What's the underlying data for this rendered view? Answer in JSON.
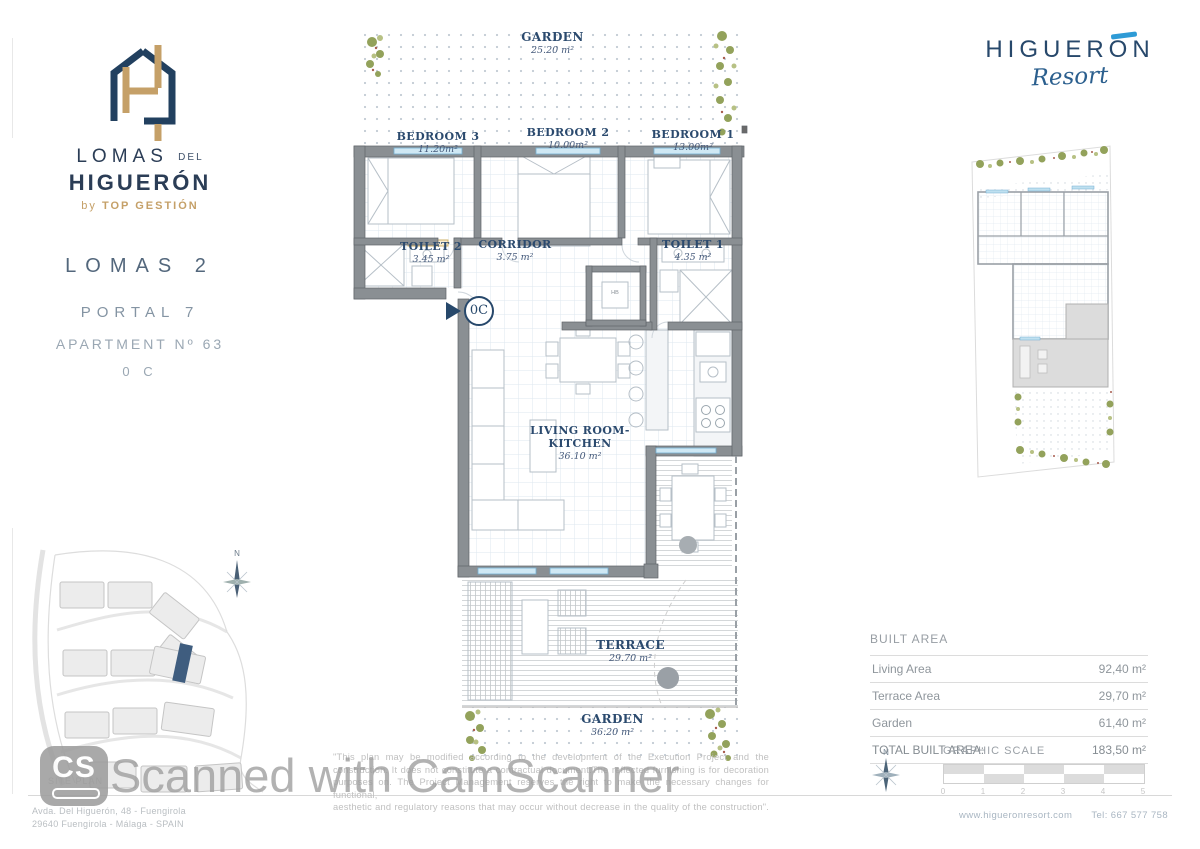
{
  "brand": {
    "line1": "LOMAS",
    "line1_small": "DEL",
    "line2": "HIGUERÓN",
    "byline_prefix": "by",
    "byline": "TOP GESTIÓN"
  },
  "unit": {
    "project": "LOMAS 2",
    "portal": "PORTAL 7",
    "apartment": "APARTMENT Nº 63",
    "code": "0 C"
  },
  "resort": {
    "name": "HIGUERON",
    "script": "Resort"
  },
  "plan": {
    "garden_top": {
      "name": "GARDEN",
      "area": "25.20 m²"
    },
    "bedroom3": {
      "name": "BEDROOM 3",
      "area": "11.20m²"
    },
    "bedroom2": {
      "name": "BEDROOM 2",
      "area": "10.00m²"
    },
    "bedroom1": {
      "name": "BEDROOM 1",
      "area": "13.00m²"
    },
    "toilet2": {
      "name": "TOILET 2",
      "area": "3.45 m²"
    },
    "corridor": {
      "name": "CORRIDOR",
      "area": "3.75 m²"
    },
    "toilet1": {
      "name": "TOILET 1",
      "area": "4.35 m²"
    },
    "living": {
      "name_line1": "LIVING ROOM-",
      "name_line2": "KITCHEN",
      "area": "36.10 m²"
    },
    "terrace": {
      "name": "TERRACE",
      "area": "29.70 m²"
    },
    "garden_bottom": {
      "name": "GARDEN",
      "area": "36.20 m²"
    },
    "entrance_code": "0C",
    "hb": "HB"
  },
  "site_plan": {
    "caption": "SITE PLAN",
    "north": "N"
  },
  "built_area": {
    "title": "BUILT AREA",
    "rows": [
      {
        "label": "Living Area",
        "value": "92,40 m²"
      },
      {
        "label": "Terrace Area",
        "value": "29,70 m²"
      },
      {
        "label": "Garden",
        "value": "61,40 m²"
      }
    ],
    "total_label": "TOTAL BUILT AREA:",
    "total_value": "183,50 m²"
  },
  "graphic_scale": {
    "label": "GRAPHIC SCALE",
    "north": "N",
    "ticks": [
      "0",
      "1",
      "2",
      "3",
      "4",
      "5"
    ]
  },
  "disclaimer": {
    "lines": [
      "\"This plan may be modified according to the development of the Execution Project and the",
      "construction. It does not constitute a contractual document.The reflected furnishing is for decoration",
      "purposes on. The Project Management reserves the right to make the necessary changes for functional,",
      "aesthetic and regulatory reasons that may occur without decrease in the quality of the construction\"."
    ]
  },
  "footer": {
    "address_line1": "Avda. Del Higuerón, 48 - Fuengirola",
    "address_line2": "29640 Fuengirola - Málaga - SPAIN",
    "website": "www.higueronresort.com",
    "phone": "Tel: 667 577 758"
  },
  "watermark": {
    "logo": "CS",
    "text": "Scanned with CamScanner"
  },
  "colors": {
    "navy": "#22405f",
    "tan": "#c5a068",
    "accent_blue": "#2e9bd6",
    "gray_text": "#98a0a6",
    "wall_gray": "#8a8f93",
    "window_blue": "#cfe8f4",
    "foliage_green": "#93a25b"
  }
}
